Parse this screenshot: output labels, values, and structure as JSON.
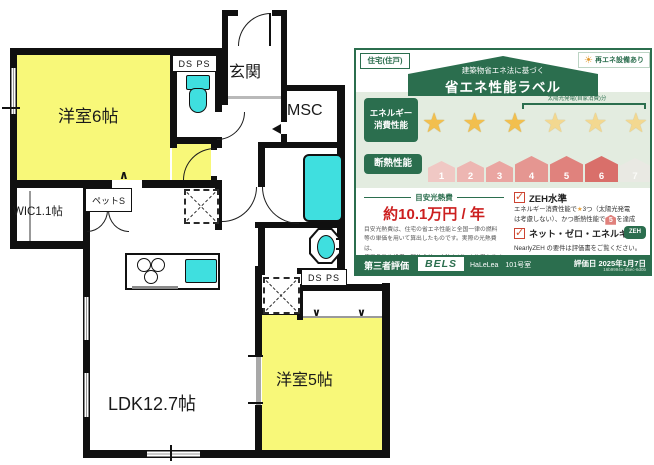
{
  "floor_plan": {
    "rooms": {
      "west6": "洋室6帖",
      "genkan": "玄関",
      "msc": "MSC",
      "wic": "WIC1.1帖",
      "pet": "ペットS",
      "ldk": "LDK12.7帖",
      "west5": "洋室5帖"
    },
    "ducts": {
      "top": "DS PS",
      "bottom": "DS PS"
    }
  },
  "energy_label": {
    "building_type": "住宅(住戸)",
    "renewable": "再エネ設備あり",
    "law_note": "建築物省エネ法に基づく",
    "title": "省エネ性能ラベル",
    "energy": {
      "label_line1": "エネルギー",
      "label_line2": "消費性能",
      "solar_note": "太陽光発電(自家消費)分",
      "stars_total": 6,
      "stars_base": 3,
      "stars_solar": 3
    },
    "insulation": {
      "label": "断熱性能",
      "levels": [
        "1",
        "2",
        "3",
        "4",
        "5",
        "6",
        "7"
      ],
      "achieved": 6
    },
    "cost": {
      "heading": "目安光熱費",
      "value": "約10.1万円 / 年",
      "note1": "目安光熱費は、住宅の省エネ性能と全国一律の燃料",
      "note2": "等の単価を用いて算出したものです。実際の光熱費は、",
      "note3": "使用条件や設備、契約会社・方法などにより異なります。"
    },
    "zeh": {
      "label": "ZEH水準",
      "note_seg1": "エネルギー消費性能で",
      "note_star": "★",
      "note_seg2": "3つ（太陽光発電",
      "note_seg3": "は考慮しない）、かつ断熱性能で",
      "house_level": "5",
      "note_seg4": "を達成"
    },
    "nze": {
      "label": "ネット・ゼロ・エネルギー",
      "badge": "ZEH",
      "note": "NearlyZEH の要件は評価書をご覧ください。"
    },
    "footer": {
      "third_party": "第三者評価",
      "brand": "BELS",
      "property": "HaLeLea　101号室",
      "date": "評価日 2025年1月7日",
      "id": "16b99941-d5ec-6d0b"
    }
  }
}
